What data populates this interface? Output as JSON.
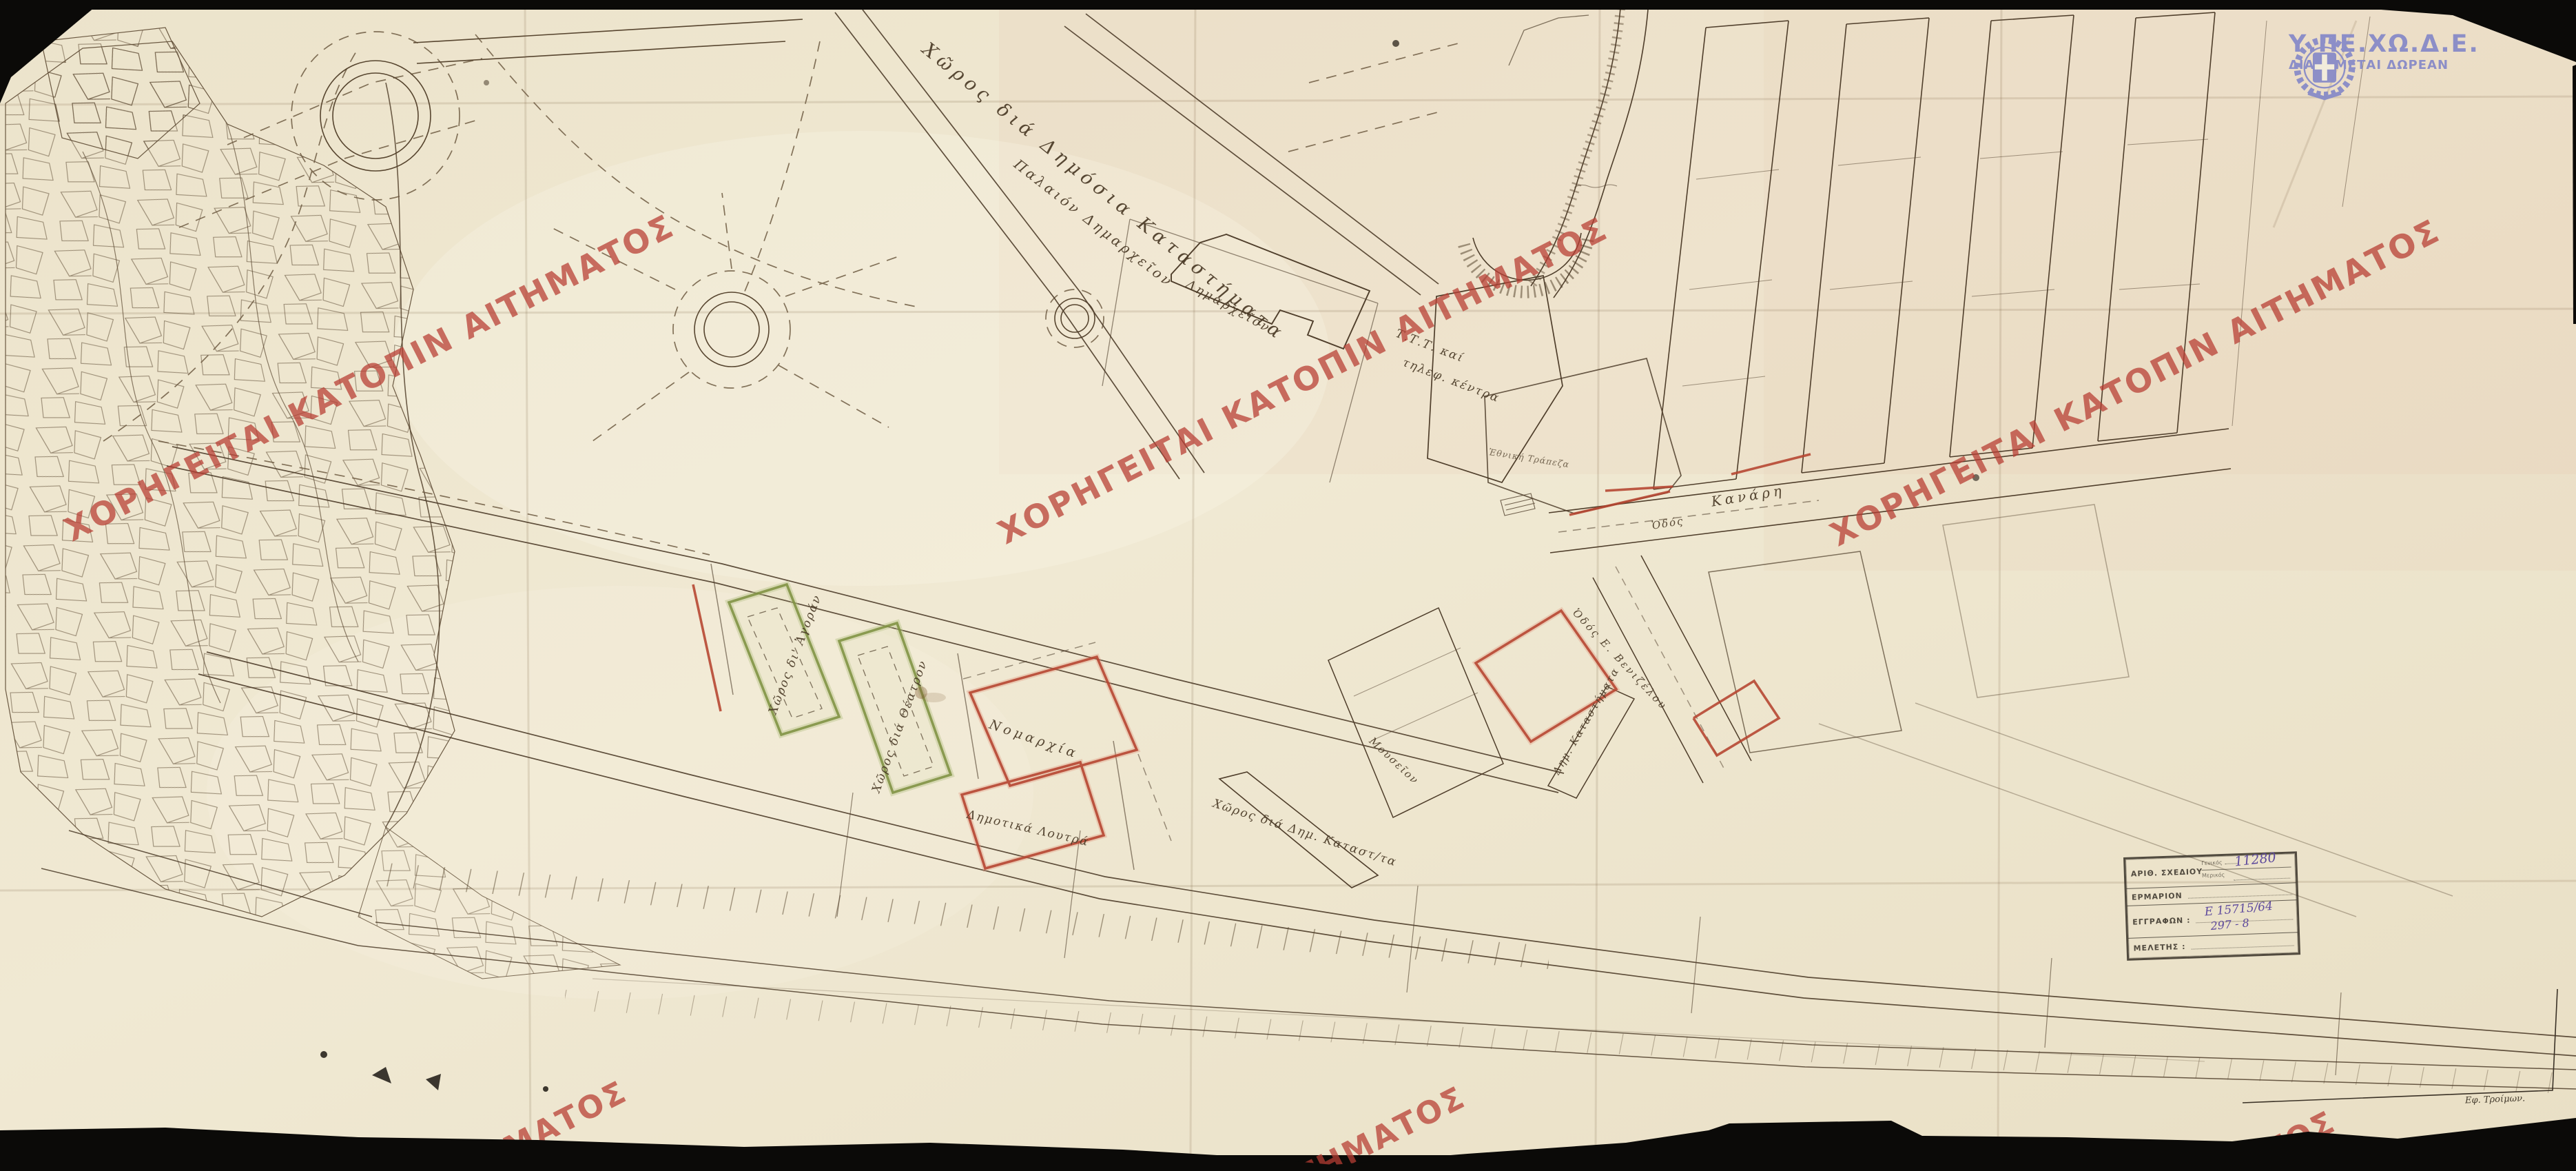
{
  "watermark": {
    "text": "ΧΟΡΗΓΕΙΤΑΙ ΚΑΤΟΠΙΝ ΑΙΤΗΜΑΤΟΣ",
    "partial": "ΙΤΗΜΑΤΟΣ",
    "partial_right": "ΤΟΣ",
    "color": "#b73e33"
  },
  "logo": {
    "title": "Υ.ΠΕ.ΧΩ.Δ.Ε.",
    "subtitle": "ΔΙΑΝΕΜΕΤΑΙ ΔΩΡΕΑΝ",
    "color": "#8589c8"
  },
  "stamp": {
    "row1_label": "ΑΡΙΘ. ΣΧΕΔΙΟΥ",
    "row1_sub1": "Γενικός",
    "row1_value": "11280",
    "row1_sub2": "Μερικός",
    "row2_label": "ΕΡΜΑΡΙΟΝ",
    "row3_label": "ΕΓΓΡΑΦΩΝ :",
    "row3_value1": "Ε 15715/64",
    "row3_value2": "297 - 8",
    "row4_label": "ΜΕΛΕΤΗΣ :"
  },
  "map_labels": {
    "dimosia_katastimata": "Χῶρος διά Δημόσια Καταστήματα",
    "palaion_dimarcheion": "Παλαιόν Δημαρχεῖον",
    "dimarcheion": "Δημαρχεῖον",
    "ttt_line1": "Τ.Τ.Τ. καί",
    "ttt_line2": "τηλεφ. κέντρα",
    "ethniki_trapeza": "Ἐθνική Τράπεζα",
    "odos": "Ὁδός",
    "kanari": "Κανάρη",
    "choros_agoran": "Χῶρος δι' Ἀγοράν",
    "choros_theatron": "Χῶρος διά Θέατρον",
    "nomarchia": "Νομαρχία",
    "dimotika_loutra": "Δημοτικά Λουτρά",
    "choros_dim_katastimata": "Χῶρος διά Δημ. Καταστ/τα",
    "mouseion": "Μουσεῖον",
    "dim_katastimata": "Δημ. Καταστήματα",
    "odos_venizelou": "Ὁδός Ε. Βενιζέλου",
    "signature": "Εφ. Τροίμων."
  }
}
